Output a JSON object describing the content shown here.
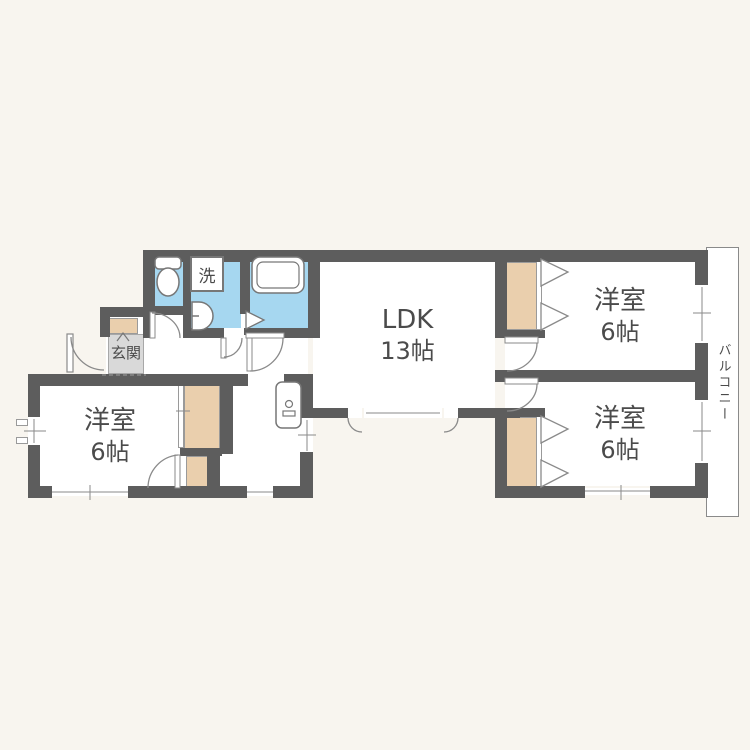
{
  "floorplan": {
    "type": "japanese-apartment-floorplan",
    "rooms": {
      "ldk": {
        "name": "LDK",
        "size": "13帖"
      },
      "bedroom_top_right": {
        "name": "洋室",
        "size": "6帖"
      },
      "bedroom_bottom_right": {
        "name": "洋室",
        "size": "6帖"
      },
      "bedroom_bottom_left": {
        "name": "洋室",
        "size": "6帖"
      },
      "genkan": {
        "name": "玄関"
      },
      "balcony": {
        "name": "バルコニー"
      },
      "laundry": {
        "label": "洗"
      }
    },
    "fixtures": [
      "toilet",
      "washing-machine",
      "washbasin",
      "bathtub",
      "kitchen-sink",
      "shoe-cabinet"
    ],
    "colors": {
      "background": "#f8f5ef",
      "wall": "#5d5d5d",
      "wet-area-blue": "#a6d7f0",
      "closet-tan": "#eacfad",
      "entry-tile-gray": "#d9d9d9",
      "line-gray": "#8a8a8a",
      "text": "#4b4b4b"
    }
  }
}
